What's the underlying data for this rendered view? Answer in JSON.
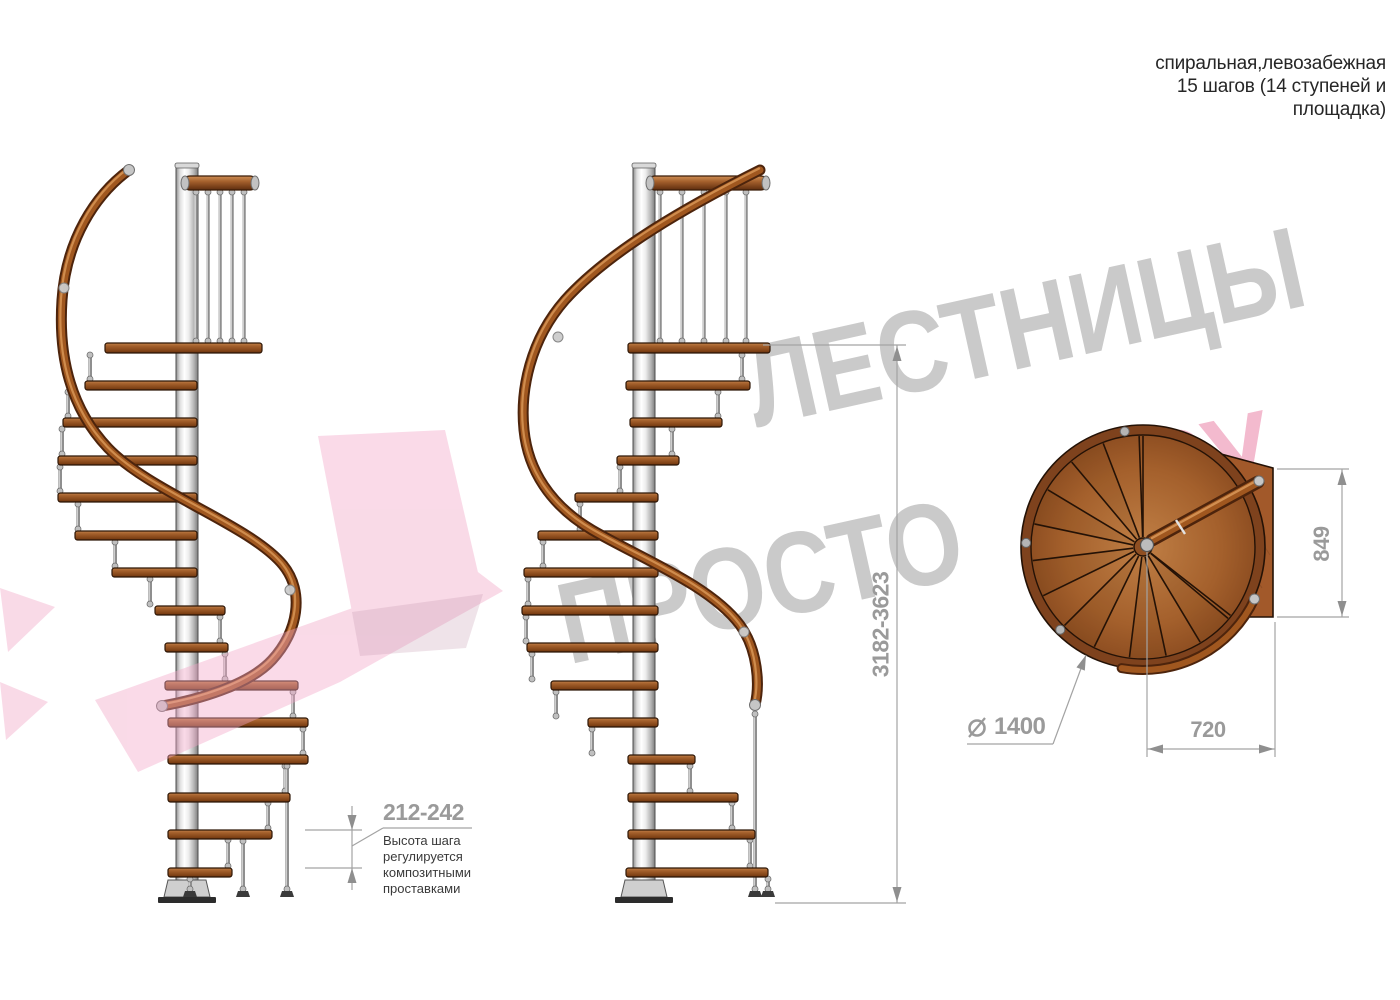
{
  "header": {
    "title_lines": [
      "спиральная,левозабежная",
      "15 шагов (14 ступеней и",
      "площадка)"
    ]
  },
  "dimensions": {
    "step_height": "212-242",
    "step_height_note_lines": [
      "Высота шага",
      "регулируется",
      "композитными",
      "проставками"
    ],
    "total_height": "3182-3623",
    "landing_depth": "849",
    "diameter_symbol": "⌀",
    "diameter_value": "1400",
    "radius_to_edge": "720"
  },
  "watermark": {
    "word1": "ЛЕСТНИЦЫ",
    "word2": "ПРОСТО",
    "suffix": ".РУ"
  },
  "colors": {
    "wood": "#a4602c",
    "wood_dark": "#5e2d0e",
    "metal": "#c9c9c9",
    "dimension_gray": "#9a9a9a",
    "watermark_gray": "#cacaca",
    "watermark_pink": "#f2aec6"
  }
}
